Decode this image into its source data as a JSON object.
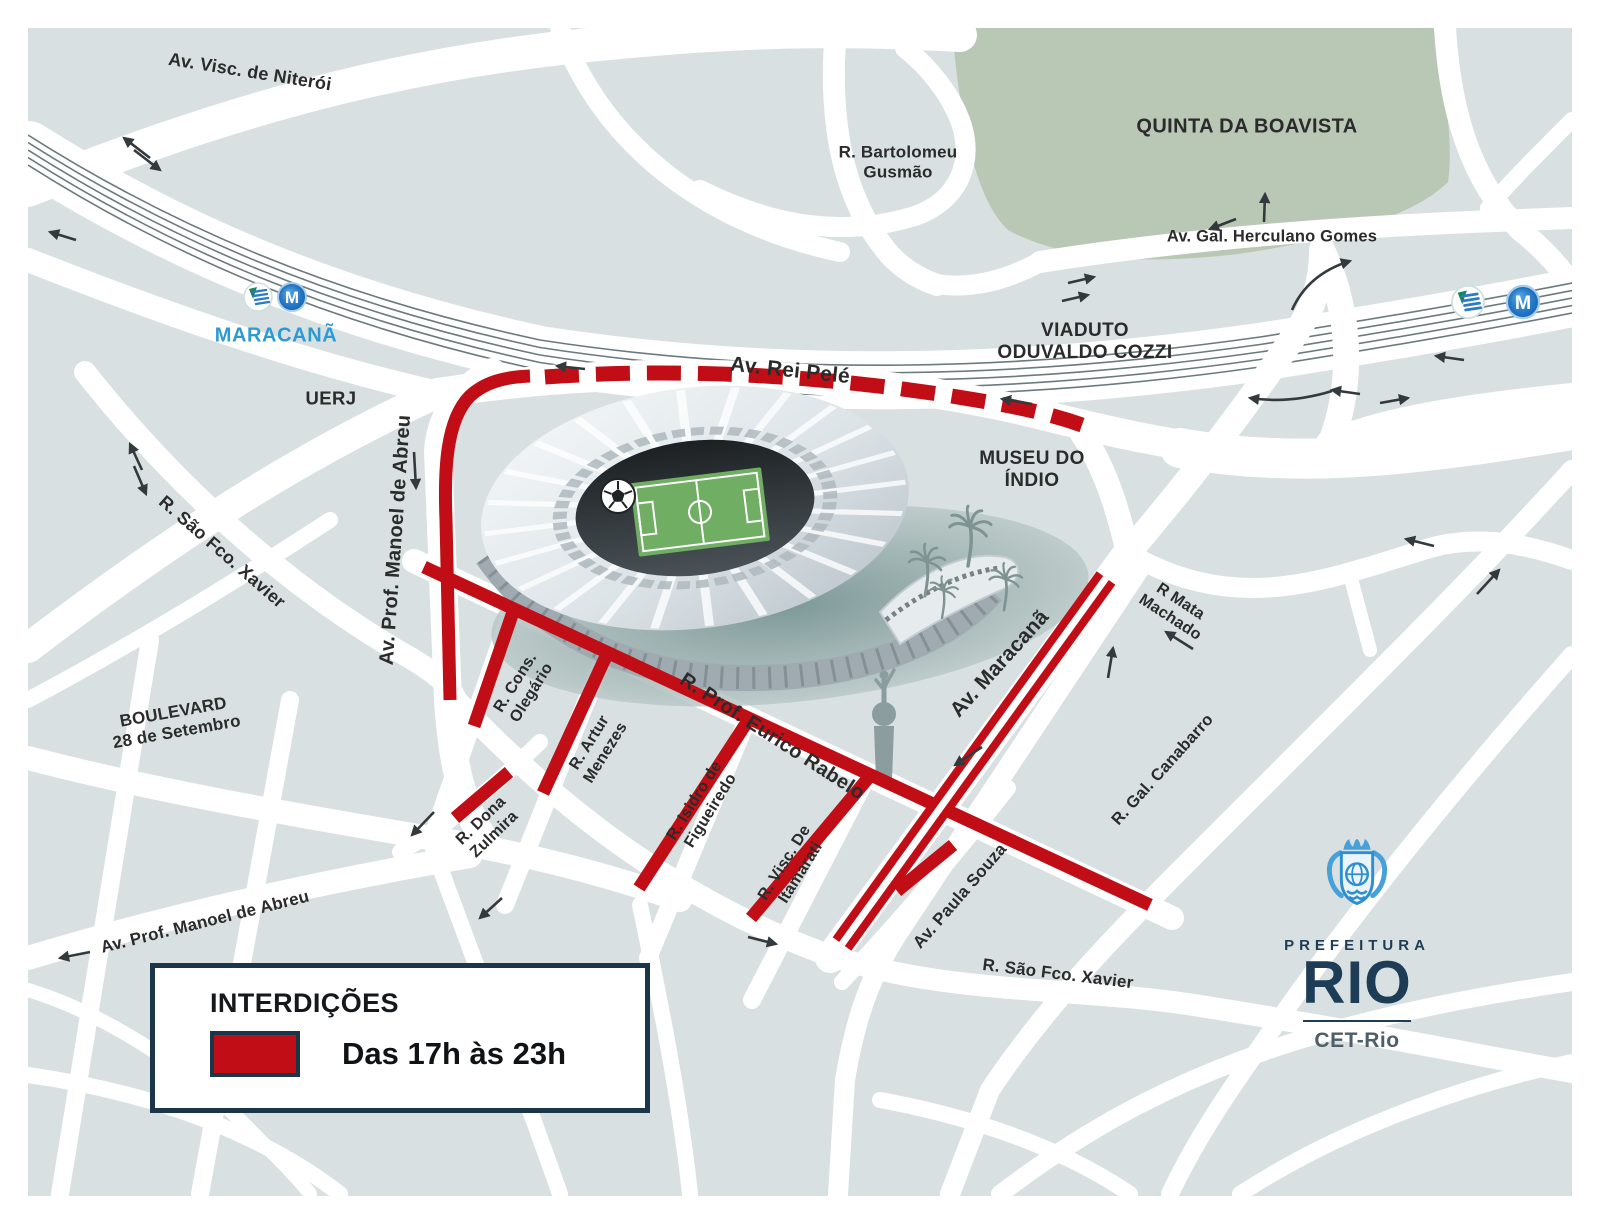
{
  "colors": {
    "map_background": "#d9e0e1",
    "road_white": "#ffffff",
    "park_green": "#b9c7b5",
    "closure_red": "#c10e16",
    "navy": "#1b3648",
    "rail_gray": "#6b7a7d",
    "station_blue": "#2e9ad3",
    "metro_blue": "#1d79c7",
    "pitch_green": "#6fae63"
  },
  "places": {
    "quinta_da_boavista": "QUINTA DA BOAVISTA",
    "uerj": "UERJ",
    "museu_do_indio": "MUSEU DO\nÍNDIO",
    "viaduto": "VIADUTO\nODUVALDO COZZI"
  },
  "streets": {
    "visc_niteroi": "Av. Visc. de Niterói",
    "bartolomeu_gusmao": "R. Bartolomeu\nGusmão",
    "herculano_gomes": "Av. Gal. Herculano Gomes",
    "rei_pele": "Av. Rei Pelé",
    "manoel_abreu_vertical": "Av. Prof. Manoel de Abreu",
    "sao_fco_xavier_nw": "R. São Fco. Xavier",
    "boulevard": "BOULEVARD\n28 de Setembro",
    "cons_olegario": "R. Cons.\nOlegário",
    "artur_menezes": "R. Artur\nMenezes",
    "eurico_rabelo": "R. Prof. Eurico Rabelo",
    "isidro_figueiredo": "R. Isidro de\nFigueiredo",
    "visc_itamarati": "R. Visc. De\nItamarati",
    "dona_zulmira": "R. Dona\nZulmira",
    "av_maracana": "Av. Maracanã",
    "mata_machado": "R Mata\nMachado",
    "gal_canabarro": "R. Gal. Canabarro",
    "paula_souza": "Av. Paula Souza",
    "sao_fco_xavier_s": "R. São Fco. Xavier",
    "manoel_abreu_sw": "Av. Prof. Manoel de Abreu"
  },
  "stations": {
    "maracana": "MARACANÃ",
    "metro_letter": "M"
  },
  "legend": {
    "title": "INTERDIÇÕES",
    "closure_label": "Das 17h às 23h"
  },
  "logo": {
    "prefeitura": "PREFEITURA",
    "city": "RIO",
    "agency": "CET-Rio"
  }
}
